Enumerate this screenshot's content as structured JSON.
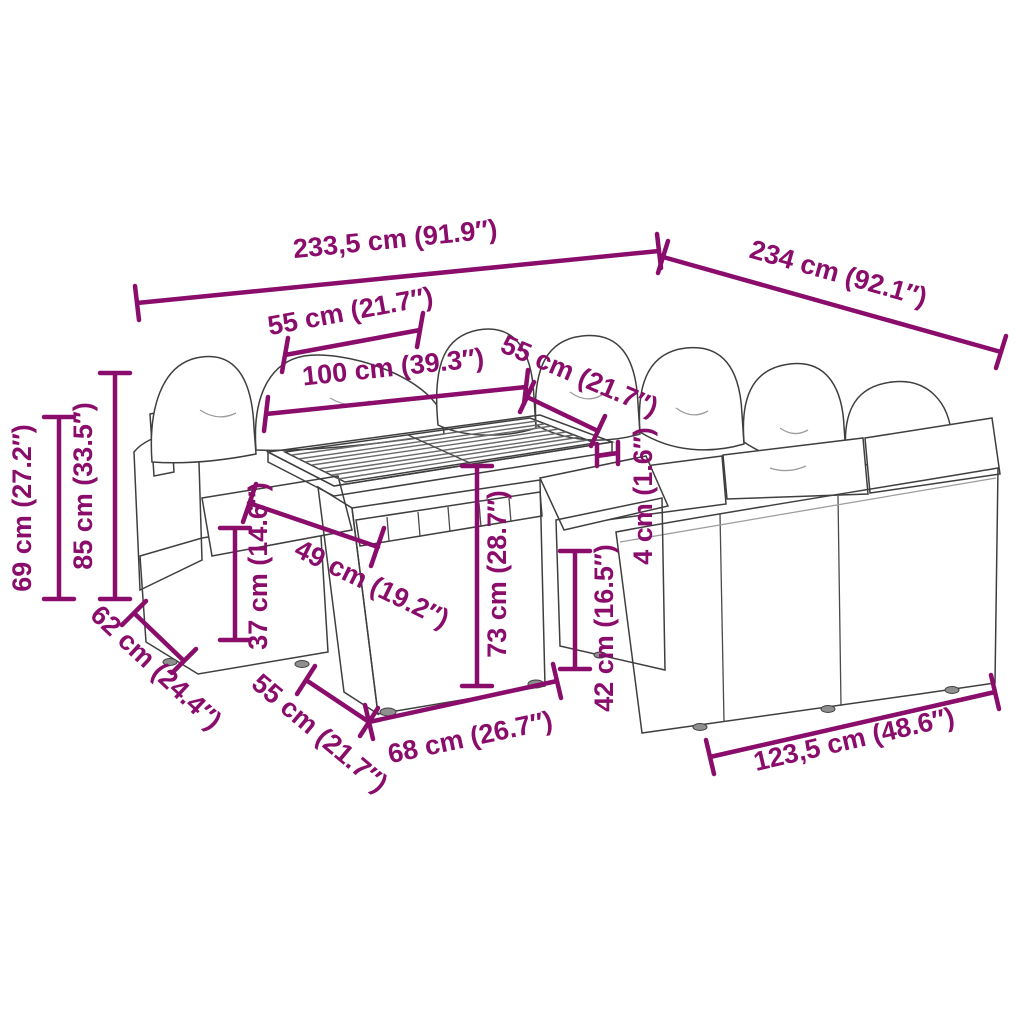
{
  "colors": {
    "accent": "#8a0c6b",
    "outline": "#3f3f3f",
    "cushion": "#ffffff"
  },
  "dimensions": {
    "total_width_back": "233,5 cm (91.9″)",
    "total_width_right": "234 cm (92.1″)",
    "back_cushion_width": "55 cm (21.7″)",
    "table_top_length": "100 cm (39.3″)",
    "seat_section_width": "55 cm (21.7″)",
    "armrest_height": "69 cm (27.2″)",
    "total_height": "85 cm (33.5″)",
    "seat_depth": "62 cm (24.4″)",
    "seat_height": "37 cm (14.6″)",
    "table_top_depth": "49 cm (19.2″)",
    "table_height": "73 cm (28.7″)",
    "base_height": "42 cm (16.5″)",
    "tabletop_thickness": "4 cm (1.6″)",
    "base_front_depth": "55 cm (21.7″)",
    "table_base_length": "68 cm (26.7″)",
    "right_sofa_length": "123,5 cm (48.6″)"
  }
}
